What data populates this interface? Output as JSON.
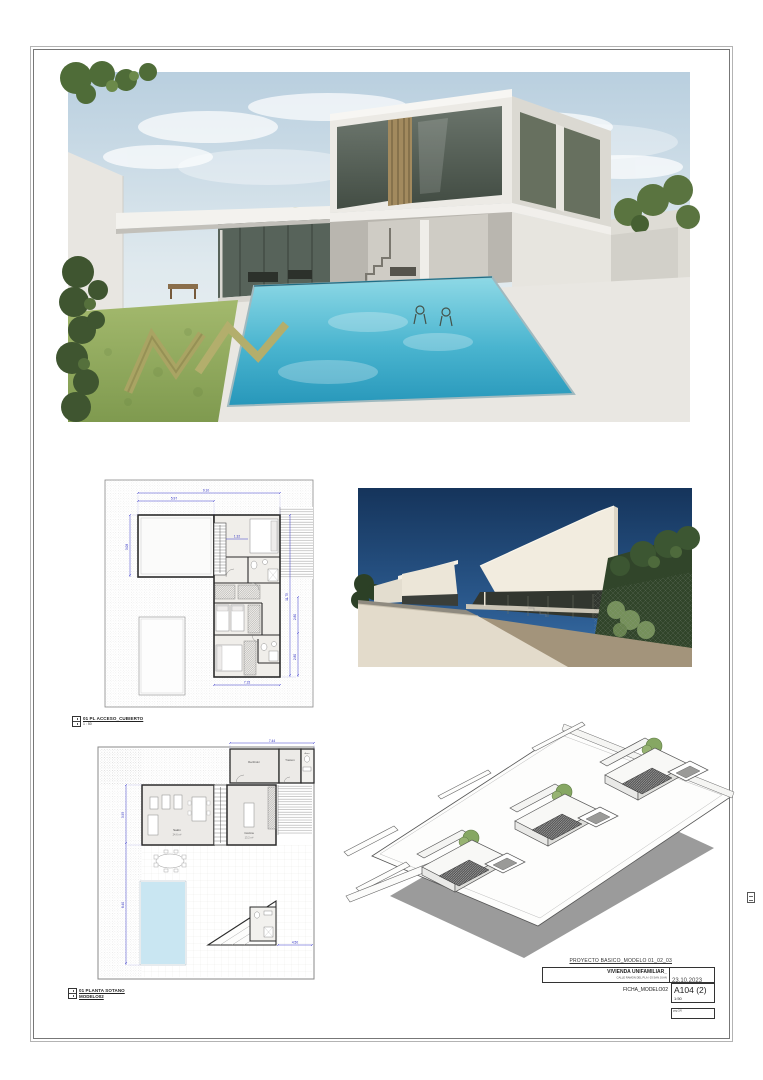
{
  "sheet": {
    "project_line": "PROYECTO BASICO_MODELO 01_02_03",
    "client": "VIVIENDA UNIFAMILIAR_",
    "address": "CALLE RAMON DEL PLA / 03 SAN JUAN",
    "date": "23.10.2023",
    "ficha": "FICHA_MODELO02",
    "sheet_number": "A104 (2)",
    "scale": "1:50",
    "page_note": "pag 2/6"
  },
  "plan_labels": {
    "upper": {
      "title": "01 PL ACCESO_CUBIERTO",
      "scale": "1 : 50"
    },
    "ground": {
      "line1": "01 PLANTA SOTANO",
      "line2": "MODELO02"
    }
  },
  "upper_plan": {
    "dims": [
      "9.10",
      "5.97",
      "3.08",
      "1.32",
      "11.75",
      "2.80",
      "2.80",
      "7.15"
    ]
  },
  "ground_plan": {
    "dims": [
      "7.44",
      "3.95",
      "8.40",
      "4.50"
    ],
    "rooms": {
      "living": "Salón",
      "living_area": "24.6 m²",
      "kitchen": "Cocina",
      "kitchen_area": "13.2 m²",
      "hall": "Recibidor",
      "storage": "Trastero",
      "bath": "Aseo"
    }
  },
  "colors": {
    "pool_water": "#49b4cf",
    "dimension_blue": "#2929c0",
    "street_sky": "#1b3a60",
    "lawn_green": "#8fa85c",
    "wall_black": "#2b2b2b"
  }
}
